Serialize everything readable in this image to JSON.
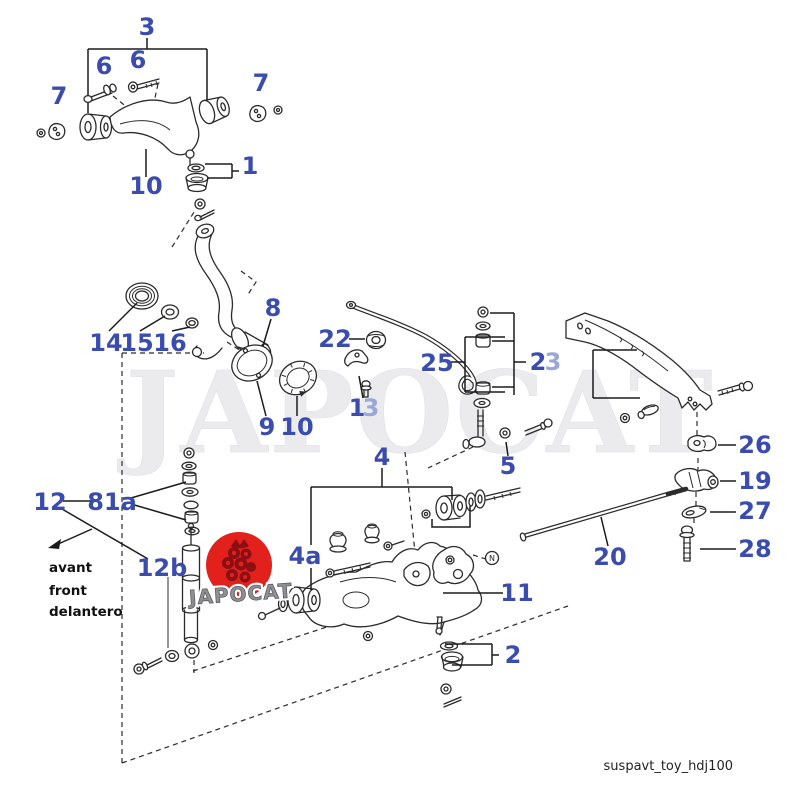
{
  "diagram": {
    "filename": "suspavt_toy_hdj100",
    "watermark": "JAPOCAT",
    "logo": {
      "text": "JAPOCAT"
    },
    "direction": {
      "line1": "avant",
      "line2": "front",
      "line3": "delantero"
    },
    "marker_n": "N",
    "colors": {
      "label_blue": "#3a4cae",
      "label_faded_blue": "#9aa6d8",
      "line_dark": "#2b2b2b",
      "logo_red": "#e3211c",
      "logo_text_gray": "#8f8f92",
      "watermark_gray": "#ebebee"
    },
    "labels": {
      "p3": "3",
      "p6a": "6",
      "p6b": "6",
      "p7a": "7",
      "p7b": "7",
      "p1": "1",
      "p10_upper": "10",
      "p14": "14",
      "p15": "15",
      "p16": "16",
      "p8": "8",
      "p9": "9",
      "p10_lower": "10",
      "p22": "22",
      "p13_a": "1",
      "p13_b": "3",
      "p25": "25",
      "p23_a": "2",
      "p23_b": "3",
      "p5": "5",
      "p26": "26",
      "p19": "19",
      "p27": "27",
      "p28": "28",
      "p20": "20",
      "p12": "12",
      "p81a": "81a",
      "p12b": "12b",
      "p4": "4",
      "p4a": "4a",
      "p11": "11",
      "p2": "2"
    }
  }
}
